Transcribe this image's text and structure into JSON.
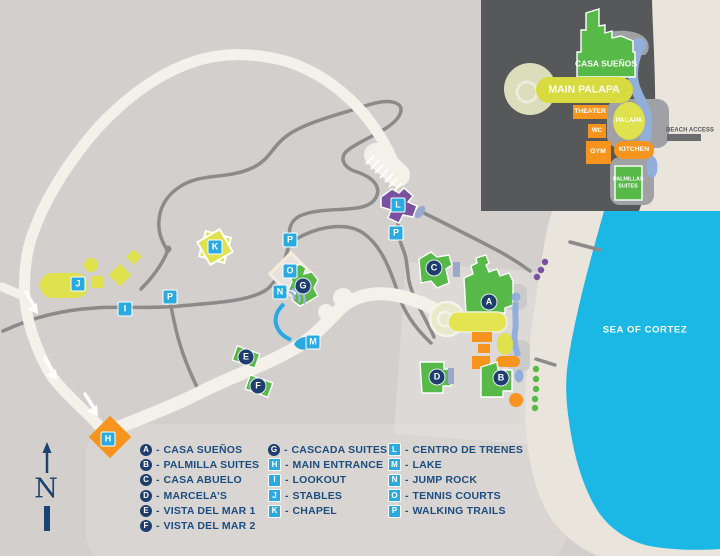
{
  "title": "Resort property map",
  "sea_label": "SEA OF CORTEZ",
  "compass_letter": "N",
  "legend": {
    "separator": "-",
    "columns": [
      [
        {
          "letter": "A",
          "shape": "circle",
          "label": "CASA SUEÑOS"
        },
        {
          "letter": "B",
          "shape": "circle",
          "label": "PALMILLA SUITES"
        },
        {
          "letter": "C",
          "shape": "circle",
          "label": "CASA ABUELO"
        },
        {
          "letter": "D",
          "shape": "circle",
          "label": "MARCELA’S"
        },
        {
          "letter": "E",
          "shape": "circle",
          "label": "VISTA DEL MAR 1"
        },
        {
          "letter": "F",
          "shape": "circle",
          "label": "VISTA DEL MAR 2"
        }
      ],
      [
        {
          "letter": "G",
          "shape": "circle",
          "label": "CASCADA SUITES"
        },
        {
          "letter": "H",
          "shape": "square",
          "label": "MAIN ENTRANCE"
        },
        {
          "letter": "I",
          "shape": "square",
          "label": "LOOKOUT"
        },
        {
          "letter": "J",
          "shape": "square",
          "label": "STABLES"
        },
        {
          "letter": "K",
          "shape": "square",
          "label": "CHAPEL"
        }
      ],
      [
        {
          "letter": "L",
          "shape": "square",
          "label": "CENTRO DE TRENES"
        },
        {
          "letter": "M",
          "shape": "square",
          "label": "LAKE"
        },
        {
          "letter": "N",
          "shape": "square",
          "label": "JUMP ROCK"
        },
        {
          "letter": "O",
          "shape": "square",
          "label": "TENNIS COURTS"
        },
        {
          "letter": "P",
          "shape": "square",
          "label": "WALKING TRAILS"
        }
      ]
    ]
  },
  "map_markers": [
    {
      "letter": "A",
      "shape": "circle",
      "x": 489,
      "y": 302
    },
    {
      "letter": "B",
      "shape": "circle",
      "x": 501,
      "y": 378
    },
    {
      "letter": "C",
      "shape": "circle",
      "x": 434,
      "y": 268
    },
    {
      "letter": "D",
      "shape": "circle",
      "x": 437,
      "y": 377
    },
    {
      "letter": "E",
      "shape": "circle",
      "x": 246,
      "y": 357
    },
    {
      "letter": "F",
      "shape": "circle",
      "x": 258,
      "y": 386
    },
    {
      "letter": "G",
      "shape": "circle",
      "x": 303,
      "y": 286
    },
    {
      "letter": "H",
      "shape": "square",
      "x": 108,
      "y": 439
    },
    {
      "letter": "I",
      "shape": "square",
      "x": 125,
      "y": 309
    },
    {
      "letter": "J",
      "shape": "square",
      "x": 78,
      "y": 284
    },
    {
      "letter": "K",
      "shape": "square",
      "x": 215,
      "y": 247
    },
    {
      "letter": "L",
      "shape": "square",
      "x": 398,
      "y": 205
    },
    {
      "letter": "M",
      "shape": "square",
      "x": 313,
      "y": 342
    },
    {
      "letter": "N",
      "shape": "square",
      "x": 280,
      "y": 292
    },
    {
      "letter": "O",
      "shape": "square",
      "x": 290,
      "y": 271
    },
    {
      "letter": "P",
      "shape": "square",
      "x": 170,
      "y": 297
    },
    {
      "letter": "P",
      "shape": "square",
      "x": 290,
      "y": 240
    },
    {
      "letter": "P",
      "shape": "square",
      "x": 396,
      "y": 233
    }
  ],
  "inset": {
    "labels": {
      "casa_suenos": "CASA SUEÑOS",
      "main_palapa": "MAIN PALAPA",
      "theater": "THEATER",
      "wc": "WC",
      "palapa": "PALAPA",
      "gym": "GYM",
      "kitchen": "KITCHEN",
      "palmillas_suites": "PALMILLAS SUITES",
      "beach_access": "BEACH ACCESS"
    }
  },
  "colors": {
    "bg": "#d3cfcd",
    "road": "#f4f1ea",
    "trail": "#8b8b8b",
    "sea": "#1cb8e5",
    "beach": "#e9e5dc",
    "green": "#56b948",
    "yellow": "#dfe14d",
    "orange": "#f7941e",
    "purple": "#7a51a0",
    "water": "#92afdb",
    "stream": "#2aa9e0",
    "marker-navy": "#1d3e6e",
    "marker-cyan": "#29abe2",
    "legend-text": "#1d4d80",
    "inset-bg": "#57585a",
    "compass": "#1c4470"
  }
}
